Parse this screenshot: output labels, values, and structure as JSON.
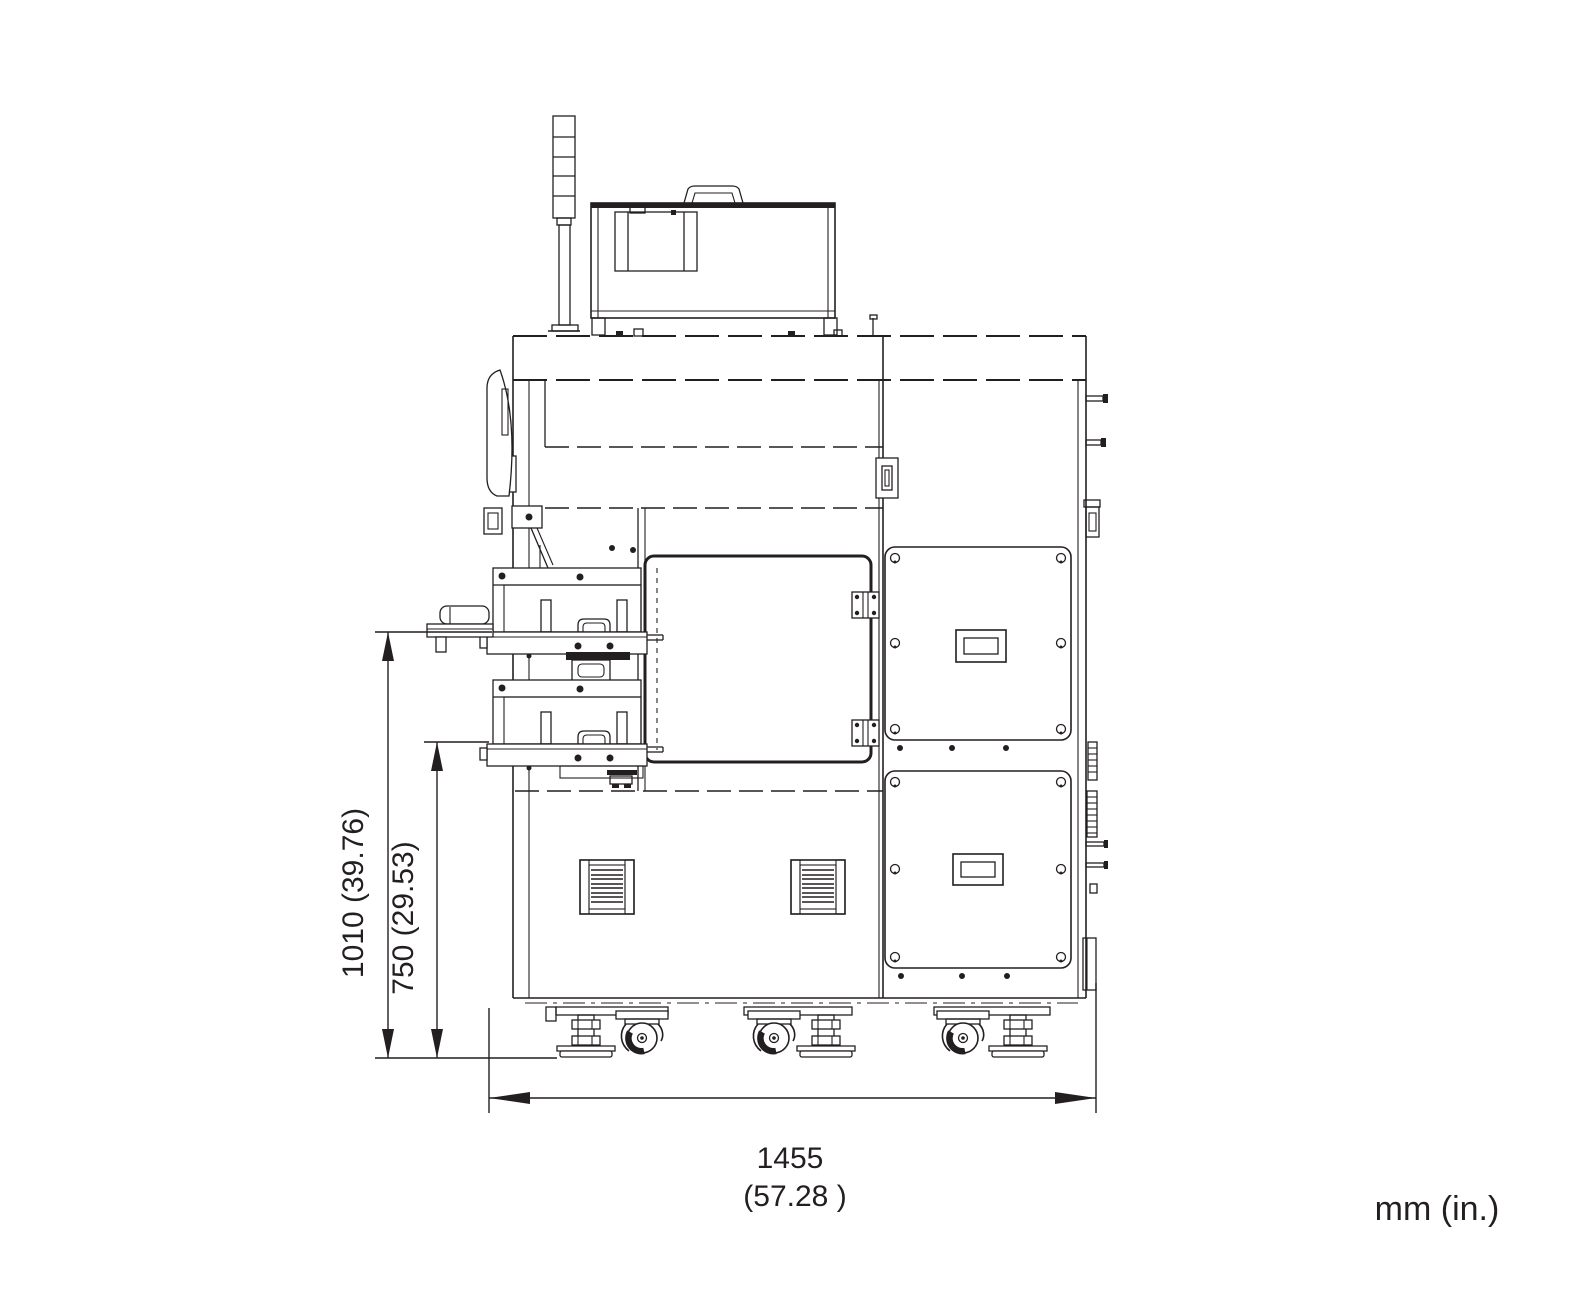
{
  "diagram": {
    "units_note": "mm (in.)",
    "line_color": "#231f20",
    "background_color": "#ffffff",
    "dim_height_outer": {
      "label": "1010 (39.76)",
      "mm": 1010,
      "inches": 39.76
    },
    "dim_height_inner": {
      "label": "750 (29.53)",
      "mm": 750,
      "inches": 29.53
    },
    "dim_width": {
      "value_mm": "1455",
      "value_in": "(57.28  )",
      "mm": 1455,
      "inches": 57.28
    }
  }
}
